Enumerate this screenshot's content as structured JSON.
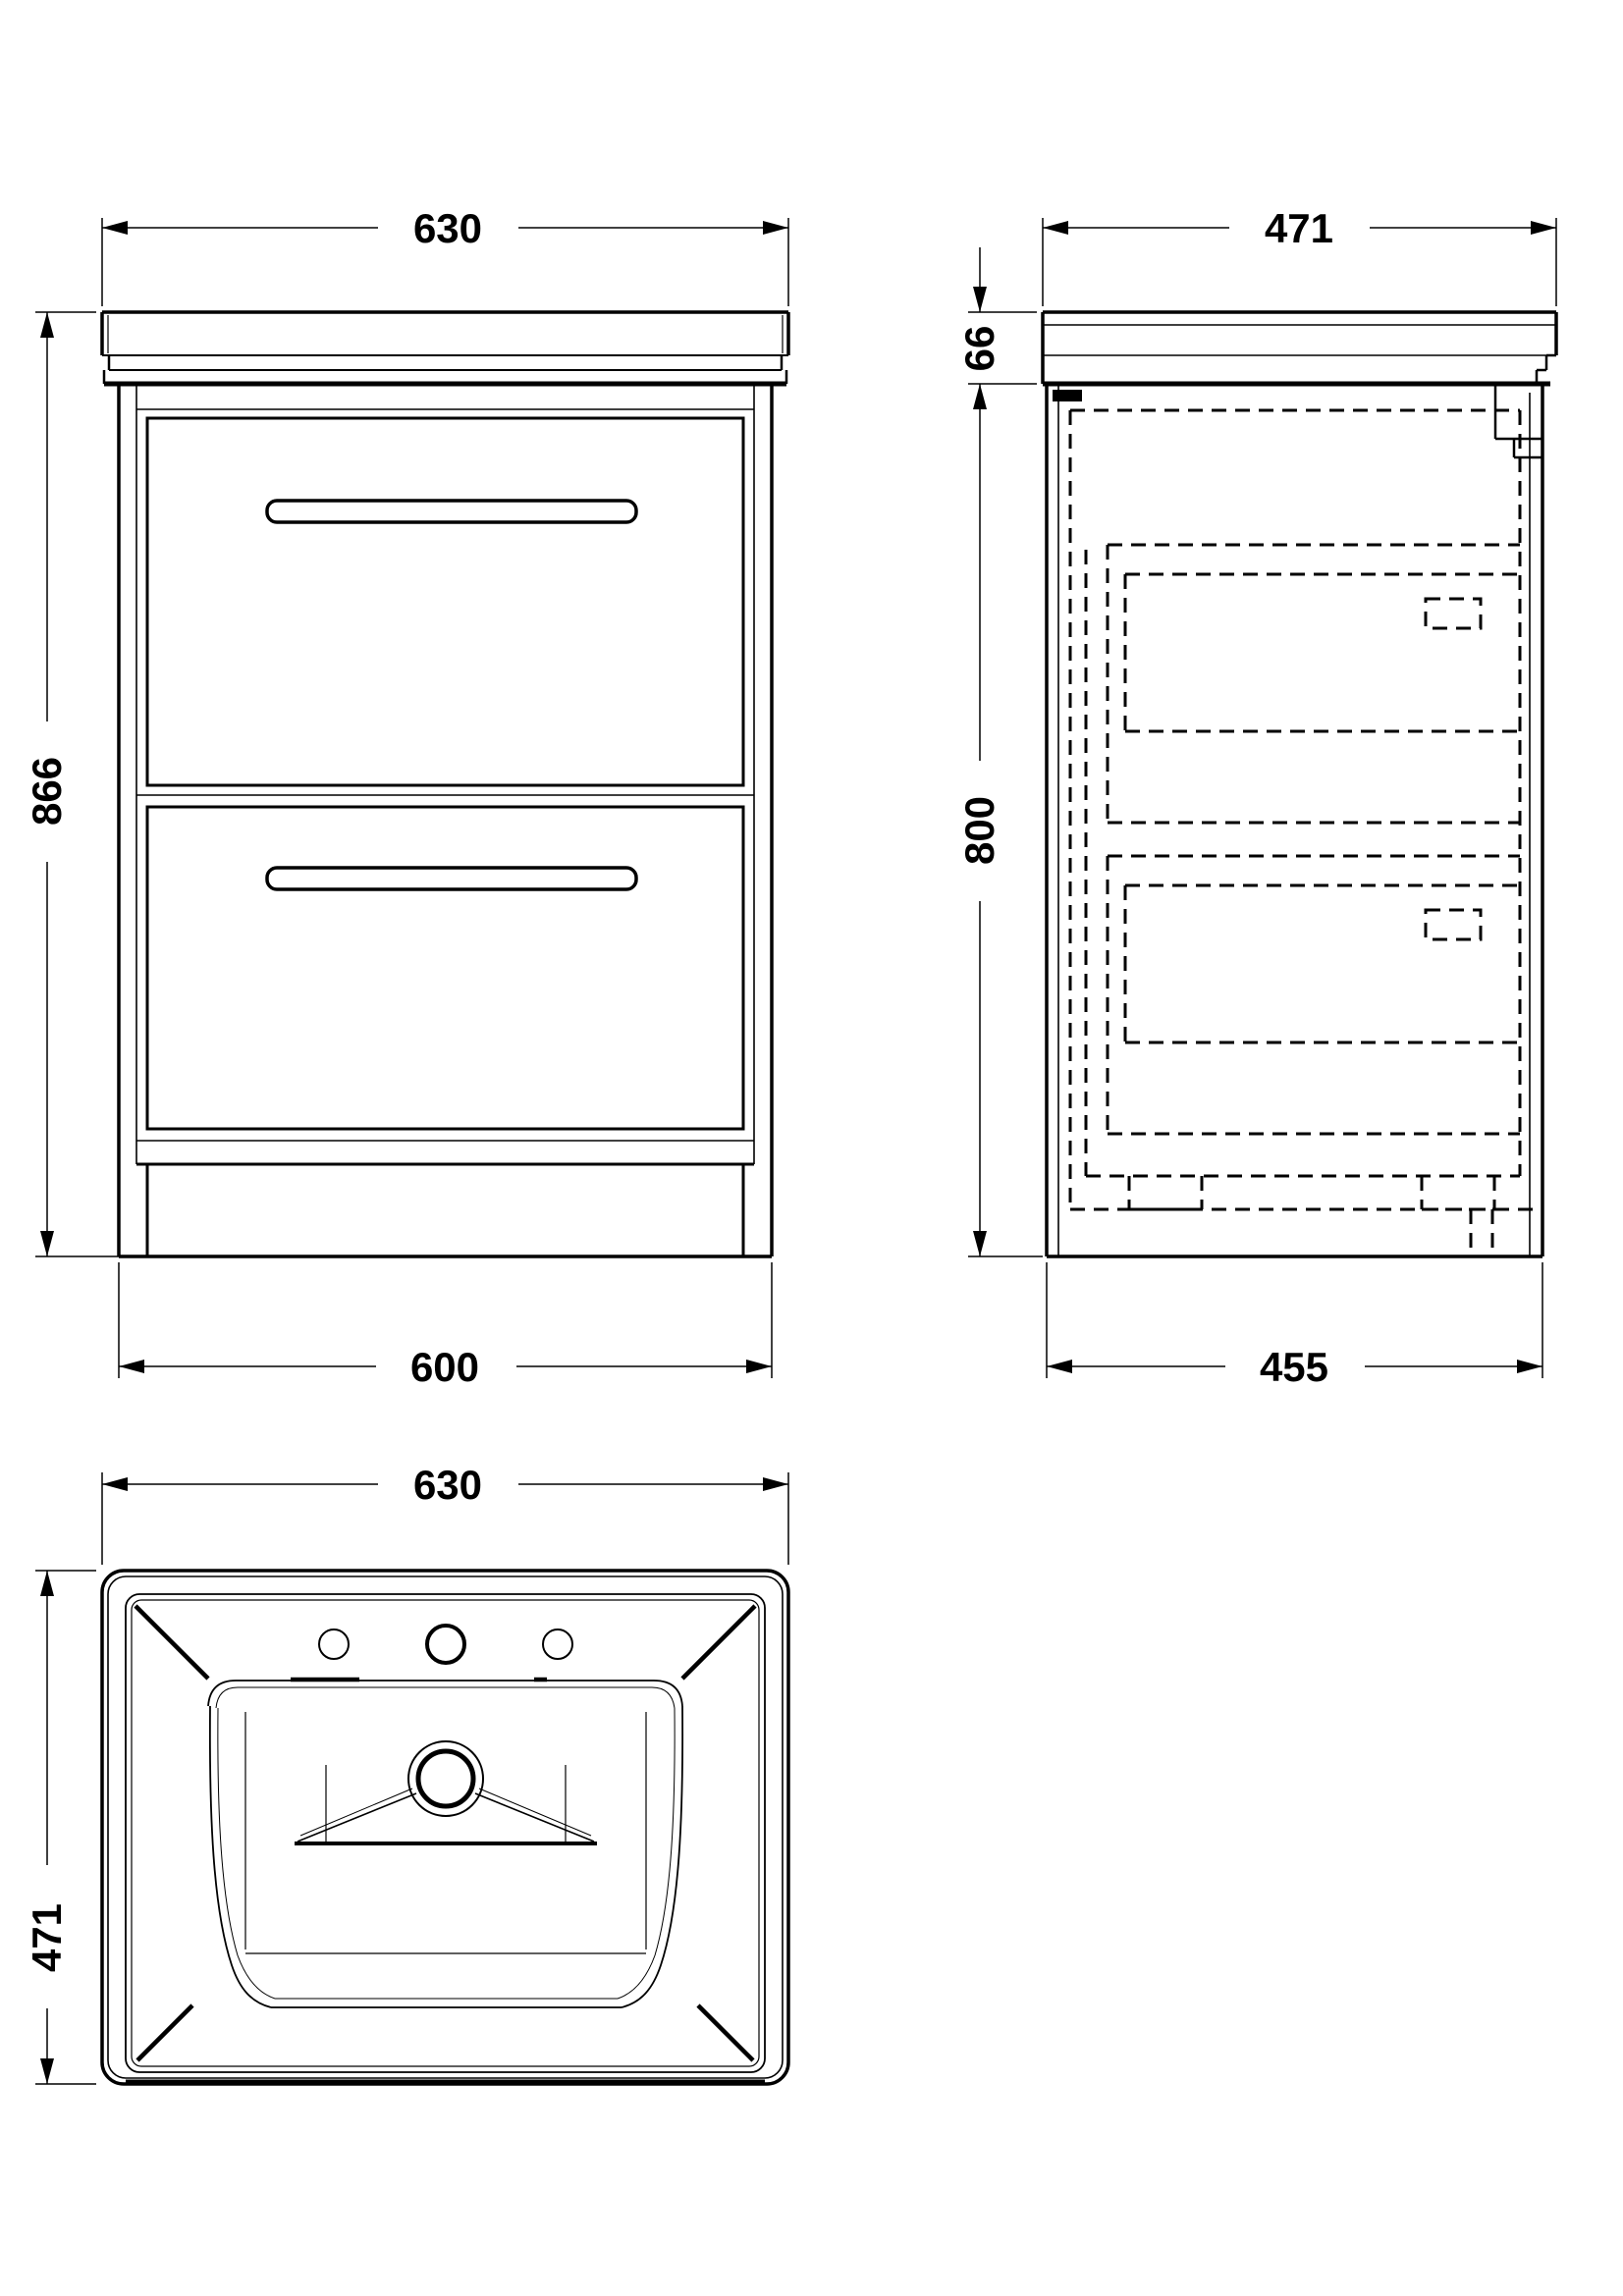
{
  "drawing": {
    "type": "bathroom vanity unit with basin - dimensioned technical drawing",
    "units": "mm",
    "views": {
      "front": {
        "label": "front elevation",
        "dim_top_width": "630",
        "dim_height": "866",
        "dim_base_width": "600"
      },
      "side": {
        "label": "side elevation",
        "dim_top_depth": "471",
        "dim_worktop_height": "66",
        "dim_cabinet_height": "800",
        "dim_base_depth": "455"
      },
      "basin": {
        "label": "basin plan view",
        "dim_width": "630",
        "dim_depth": "471"
      }
    }
  }
}
